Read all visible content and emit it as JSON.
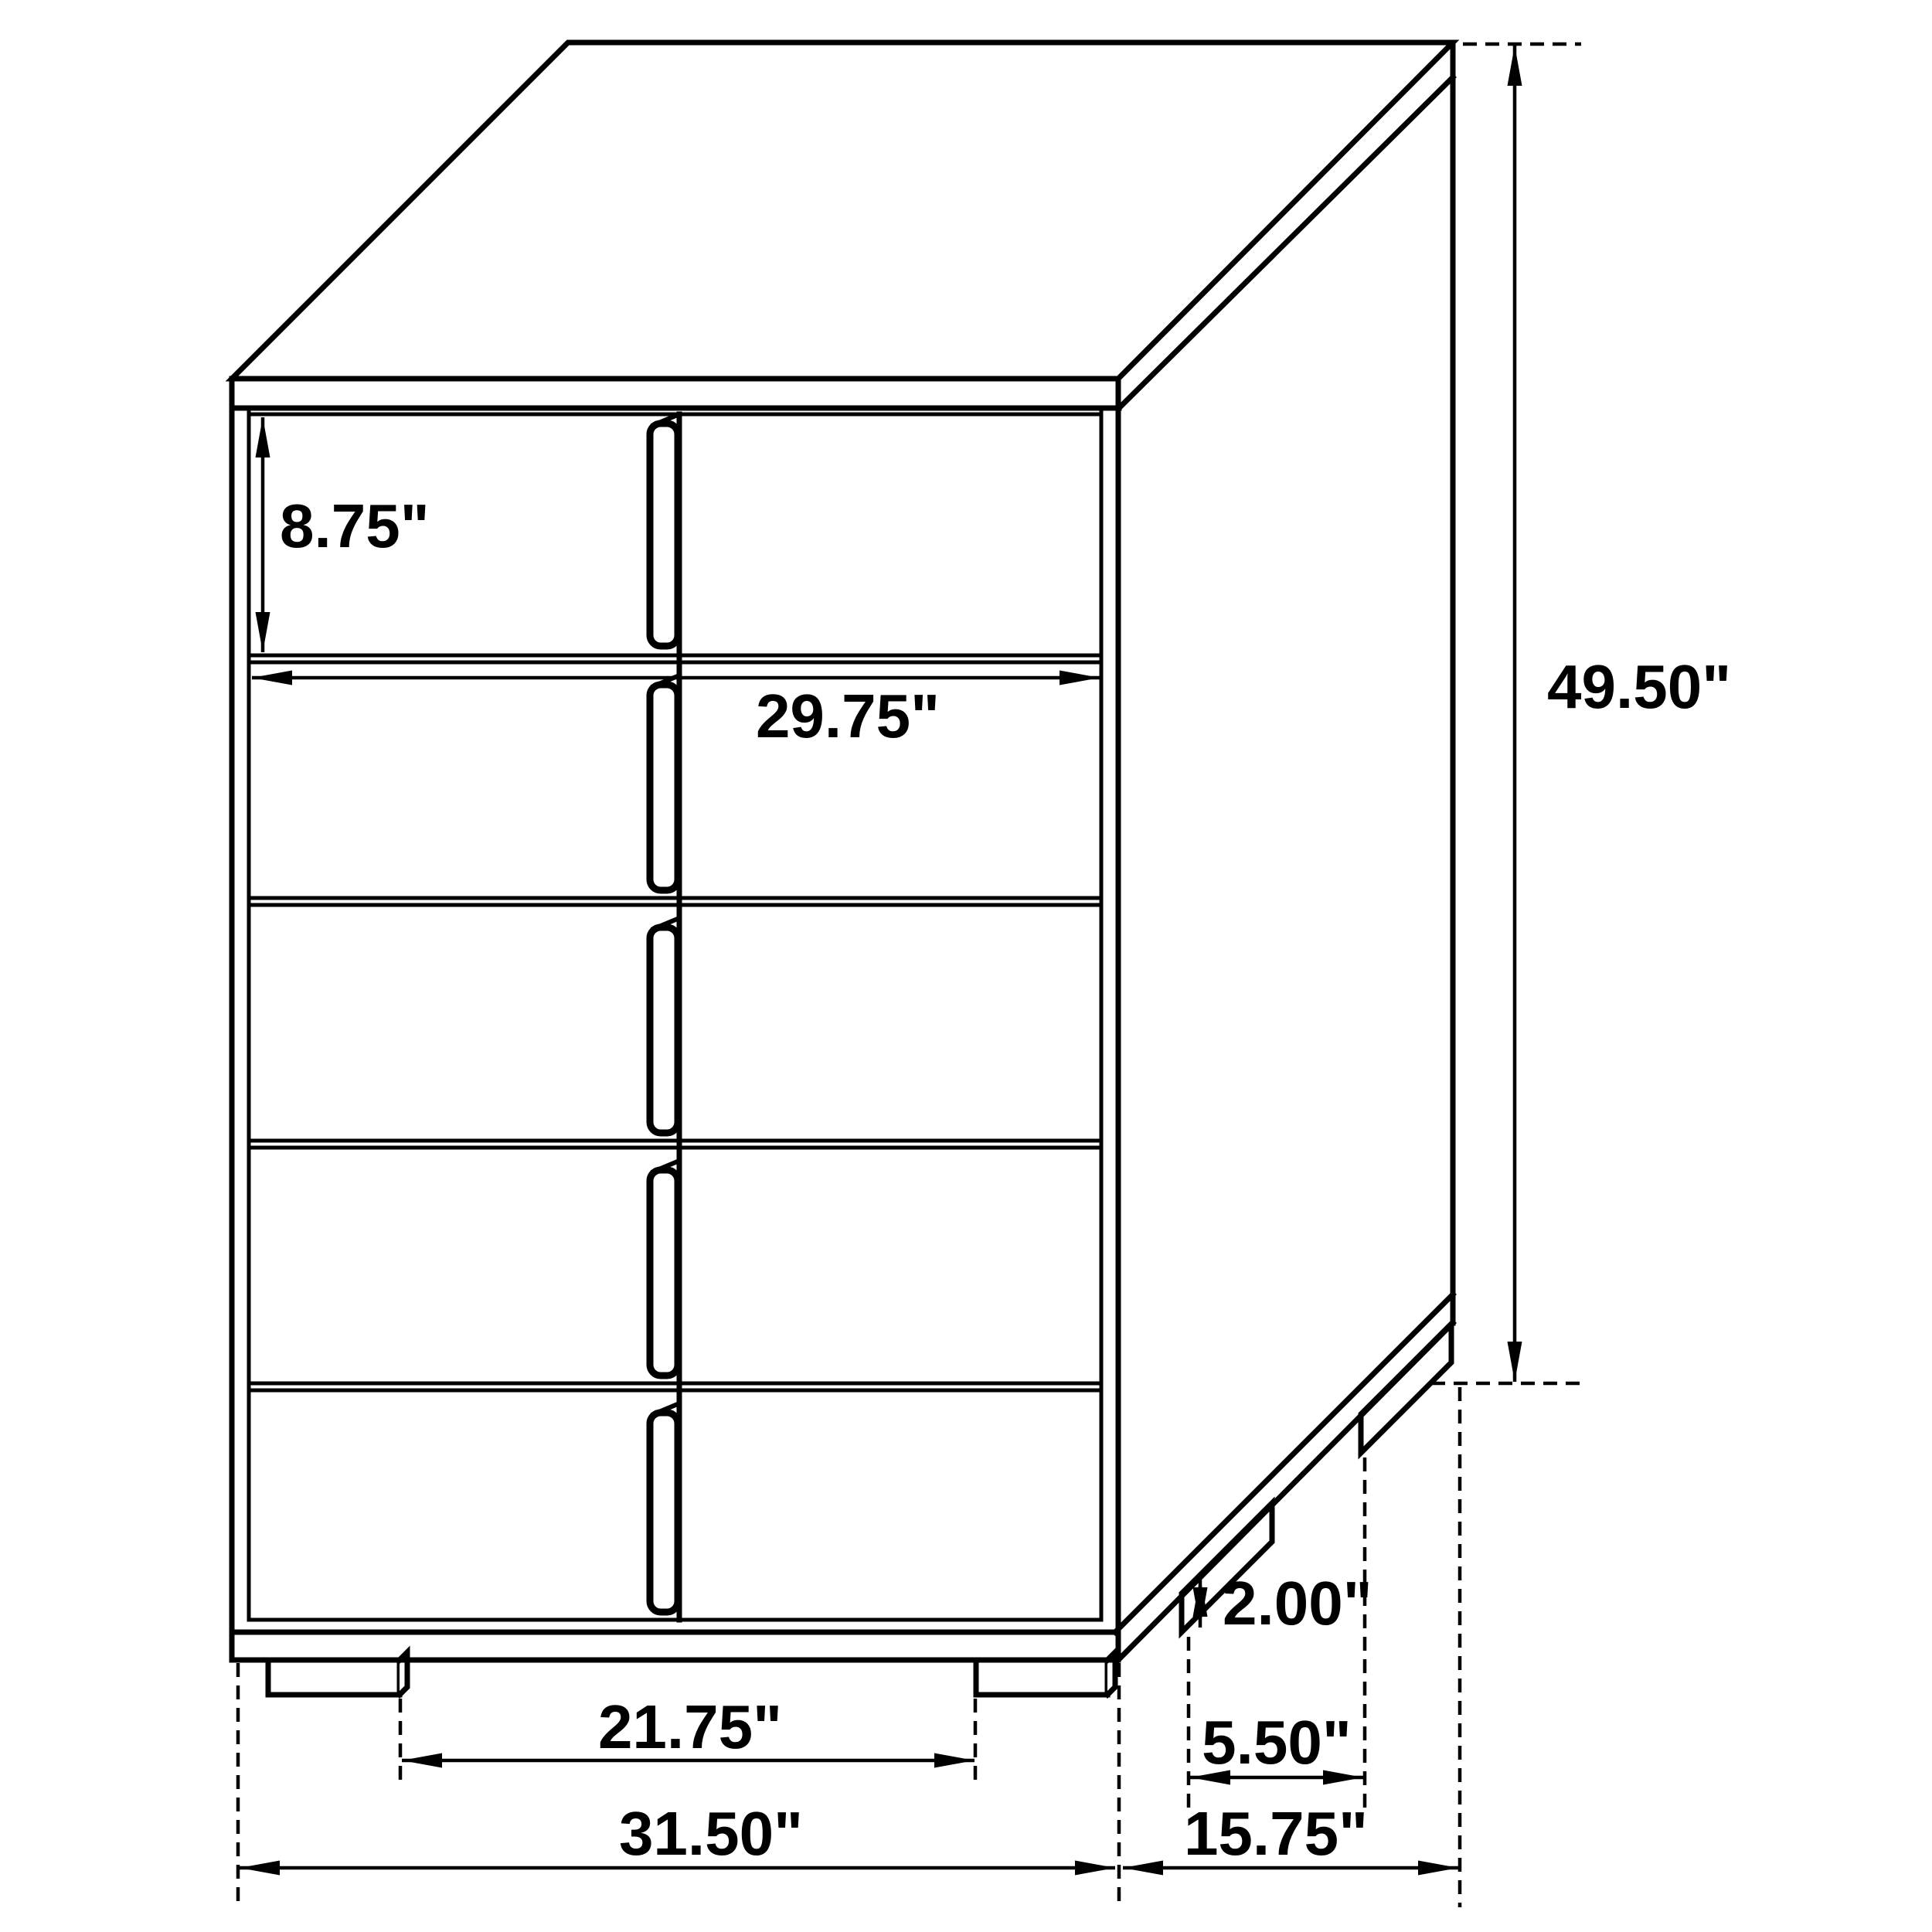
{
  "diagram": {
    "description": "Chest of drawers isometric dimension drawing",
    "unit": "inches",
    "dims": {
      "drawer_height": "8.75\"",
      "drawer_width": "29.75\"",
      "overall_height": "49.50\"",
      "foot_height": "2.00\"",
      "foot_inset_depth": "5.50\"",
      "foot_spacing_width": "21.75\"",
      "overall_width": "31.50\"",
      "overall_depth": "15.75\""
    }
  }
}
